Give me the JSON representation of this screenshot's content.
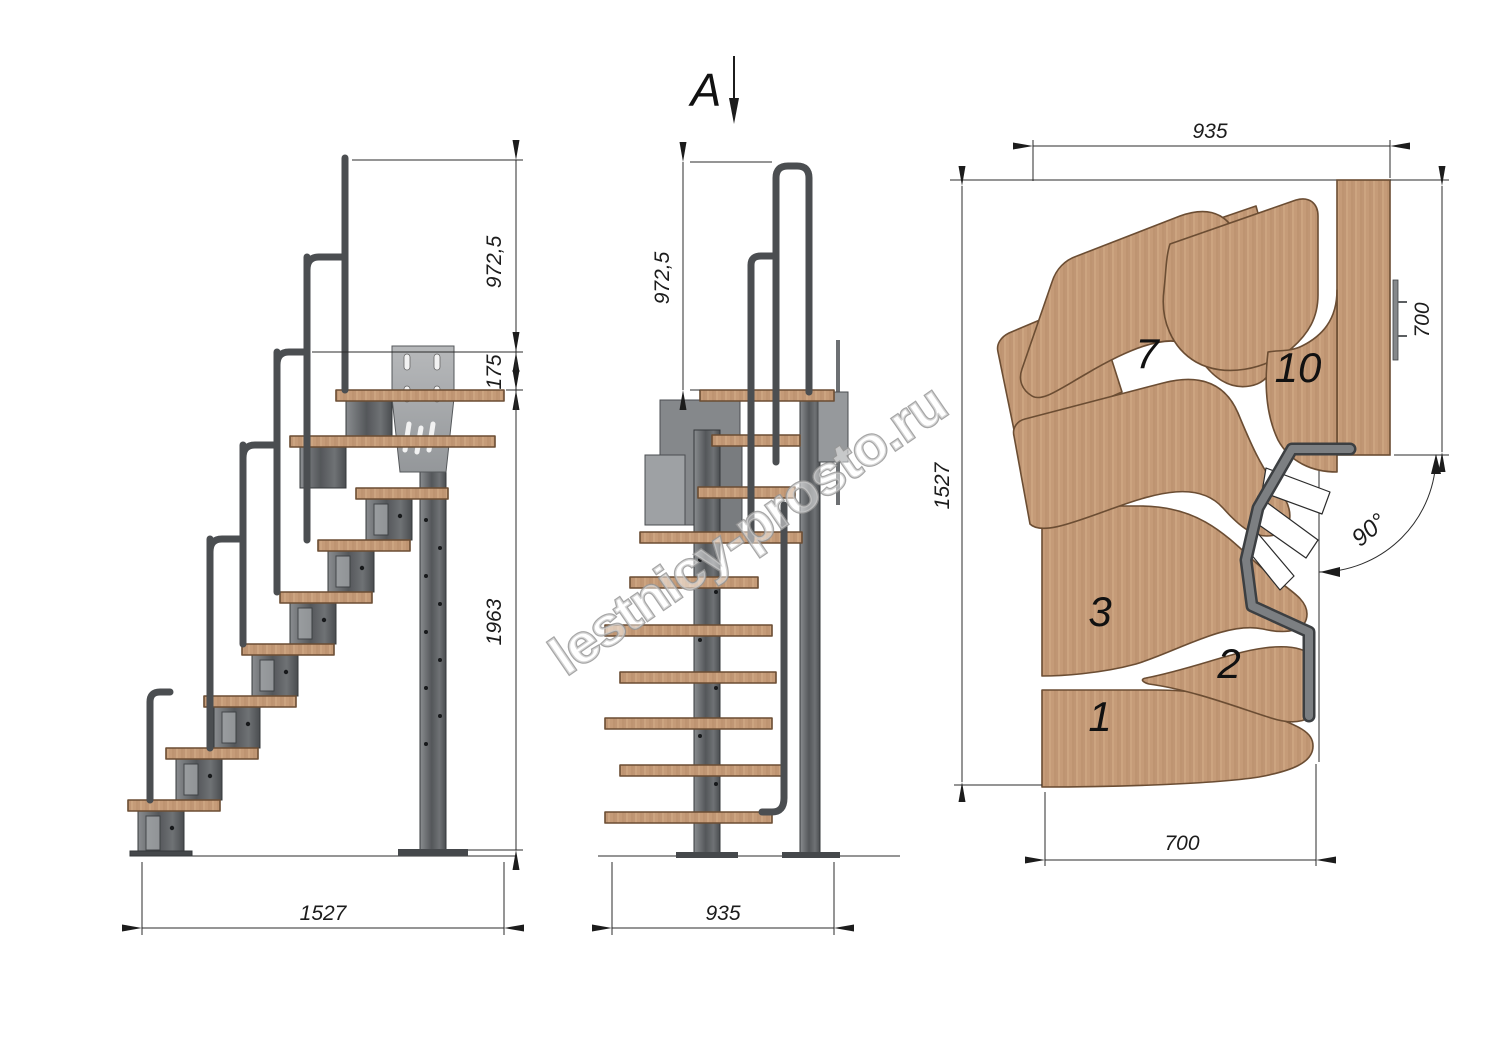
{
  "drawing_type": "modular staircase technical drawing, three views",
  "watermark": {
    "text": "lestnicy-prosto.ru"
  },
  "side_view": {
    "name": "side elevation",
    "dimensions": {
      "rail_height": "972,5",
      "rail_offset": "175",
      "height_to_landing": "1963",
      "run_length": "1527"
    }
  },
  "front_view": {
    "name": "front elevation",
    "section_label": "A",
    "dimensions": {
      "rail_height": "972,5",
      "width": "935"
    }
  },
  "plan_view": {
    "name": "top plan view",
    "dimensions": {
      "top_width": "935",
      "landing_depth": "700",
      "total_depth": "1527",
      "bottom_width": "700",
      "turn_angle": "90°"
    },
    "treads": [
      {
        "label": "1"
      },
      {
        "label": "2"
      },
      {
        "label": "3"
      },
      {
        "label": "7"
      },
      {
        "label": "10"
      }
    ]
  },
  "colors": {
    "wood": "#c59b78",
    "wood_edge": "#6b4d33",
    "metal_dark": "#4b4e51",
    "metal_mid": "#7c7f82",
    "plate": "#aaadb0",
    "line": "#2b2b2b",
    "watermark_outline": "#979797"
  }
}
